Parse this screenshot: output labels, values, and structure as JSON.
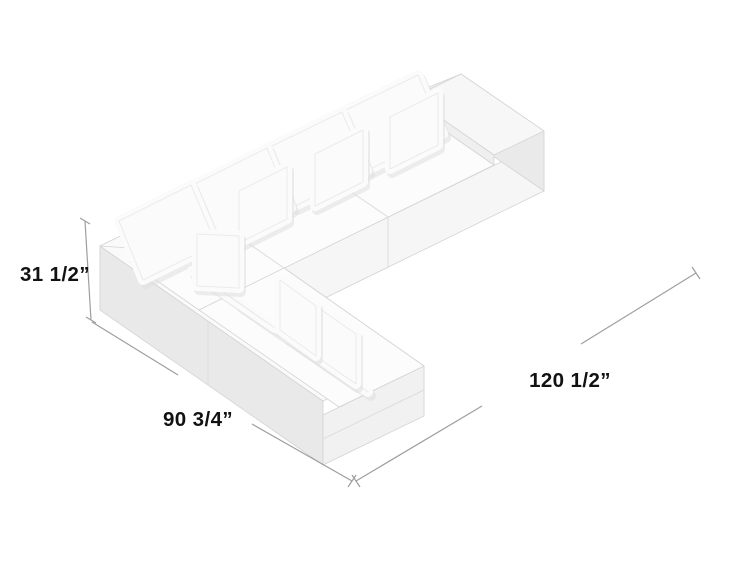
{
  "diagram": {
    "description": "Isometric product drawing of a white L-shaped sectional sofa with back cushions and throw pillows, annotated with dimension lines",
    "dims": {
      "height": "31 1/2”",
      "depth": "90 3/4”",
      "width": "120 1/2”"
    },
    "colors": {
      "background": "#ffffff",
      "dimension_line": "#9e9e9e",
      "label_text": "#121212",
      "sofa_top": "#fcfcfc",
      "sofa_front": "#f6f6f6",
      "sofa_side": "#e9e9e9",
      "cushion_shadow": "#e2e2e2"
    }
  }
}
